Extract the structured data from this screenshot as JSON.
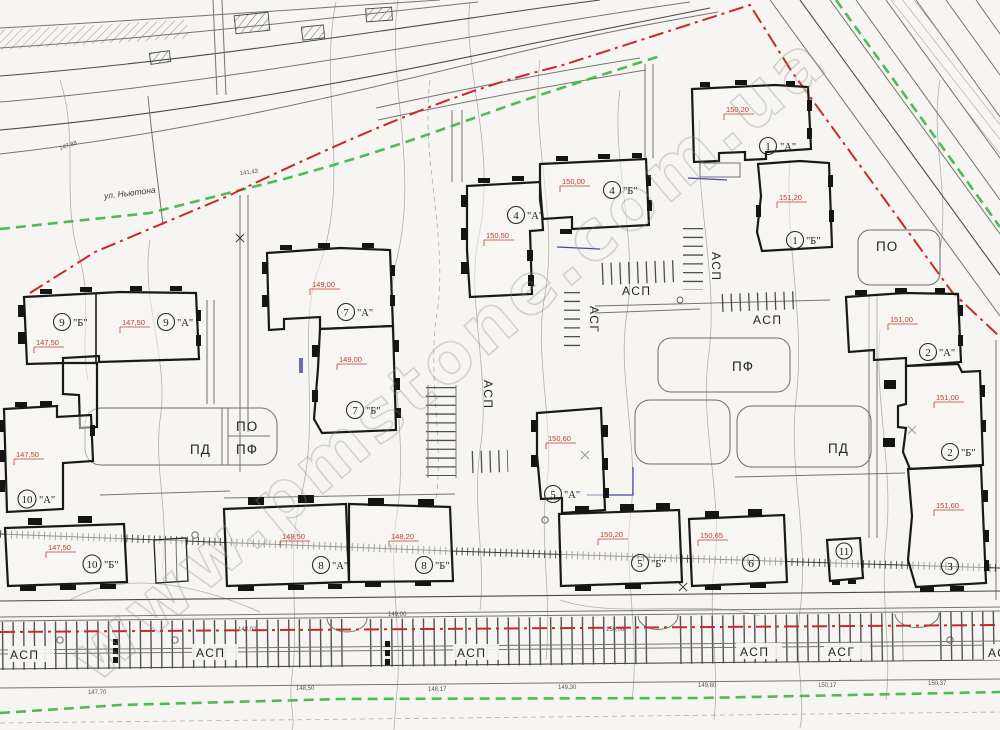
{
  "drawing": {
    "street_label": "ул. Ньютона",
    "watermark": "www.pmstone.com.ua"
  },
  "buildings": [
    {
      "number": "1",
      "letter": "\"А\"",
      "elevation": "150,20"
    },
    {
      "number": "1",
      "letter": "\"Б\"",
      "elevation": "151,20"
    },
    {
      "number": "2",
      "letter": "\"А\"",
      "elevation": "151,00"
    },
    {
      "number": "2",
      "letter": "\"Б\"",
      "elevation": "151,00"
    },
    {
      "number": "3",
      "letter": "",
      "elevation": "151,60"
    },
    {
      "number": "4",
      "letter": "\"А\"",
      "elevation": "150,50"
    },
    {
      "number": "4",
      "letter": "\"Б\"",
      "elevation": "150,00"
    },
    {
      "number": "5",
      "letter": "\"А\"",
      "elevation": "150,60"
    },
    {
      "number": "5",
      "letter": "\"Б\"",
      "elevation": "150,20"
    },
    {
      "number": "6",
      "letter": "",
      "elevation": "150,65"
    },
    {
      "number": "7",
      "letter": "\"А\"",
      "elevation": "149,00"
    },
    {
      "number": "7",
      "letter": "\"Б\"",
      "elevation": "149,00"
    },
    {
      "number": "8",
      "letter": "\"А\"",
      "elevation": "148,50"
    },
    {
      "number": "8",
      "letter": "\"Б\"",
      "elevation": "148,20"
    },
    {
      "number": "9",
      "letter": "\"Б\"",
      "elevation": "147,50"
    },
    {
      "number": "9",
      "letter": "\"А\"",
      "elevation": "147,50"
    },
    {
      "number": "10",
      "letter": "\"А\"",
      "elevation": "147,50"
    },
    {
      "number": "10",
      "letter": "\"Б\"",
      "elevation": "147,50"
    },
    {
      "number": "11",
      "letter": "",
      "elevation": ""
    }
  ],
  "areas": [
    {
      "text": "ПО"
    },
    {
      "text": "ПФ"
    },
    {
      "text": "ПД"
    },
    {
      "text": "ПО"
    },
    {
      "text": "ПФ"
    },
    {
      "text": "ПД"
    }
  ],
  "parking_labels": [
    {
      "text": "АСП"
    },
    {
      "text": "АСП"
    },
    {
      "text": "АСГ"
    },
    {
      "text": "АСП"
    },
    {
      "text": "АСП"
    },
    {
      "text": "АСП"
    },
    {
      "text": "АСП"
    },
    {
      "text": "АСП"
    },
    {
      "text": "АСП"
    },
    {
      "text": "АСГ"
    },
    {
      "text": "АСП"
    }
  ],
  "spot_elevations": [
    "147,70",
    "147,88",
    "148,02",
    "148,17",
    "148,50",
    "149,00",
    "149,30",
    "149,80",
    "150,06",
    "150,17",
    "150,37",
    "151,20",
    "141,43"
  ],
  "colors": {
    "boundary_red": "#c82a2a",
    "utility_green": "#3cb54a",
    "pipe_blue": "#4646b4",
    "elevation_red": "#c23b34",
    "paper": "#f6f5f1",
    "ink": "#191919",
    "contour_gray": "#b2b0ac"
  }
}
